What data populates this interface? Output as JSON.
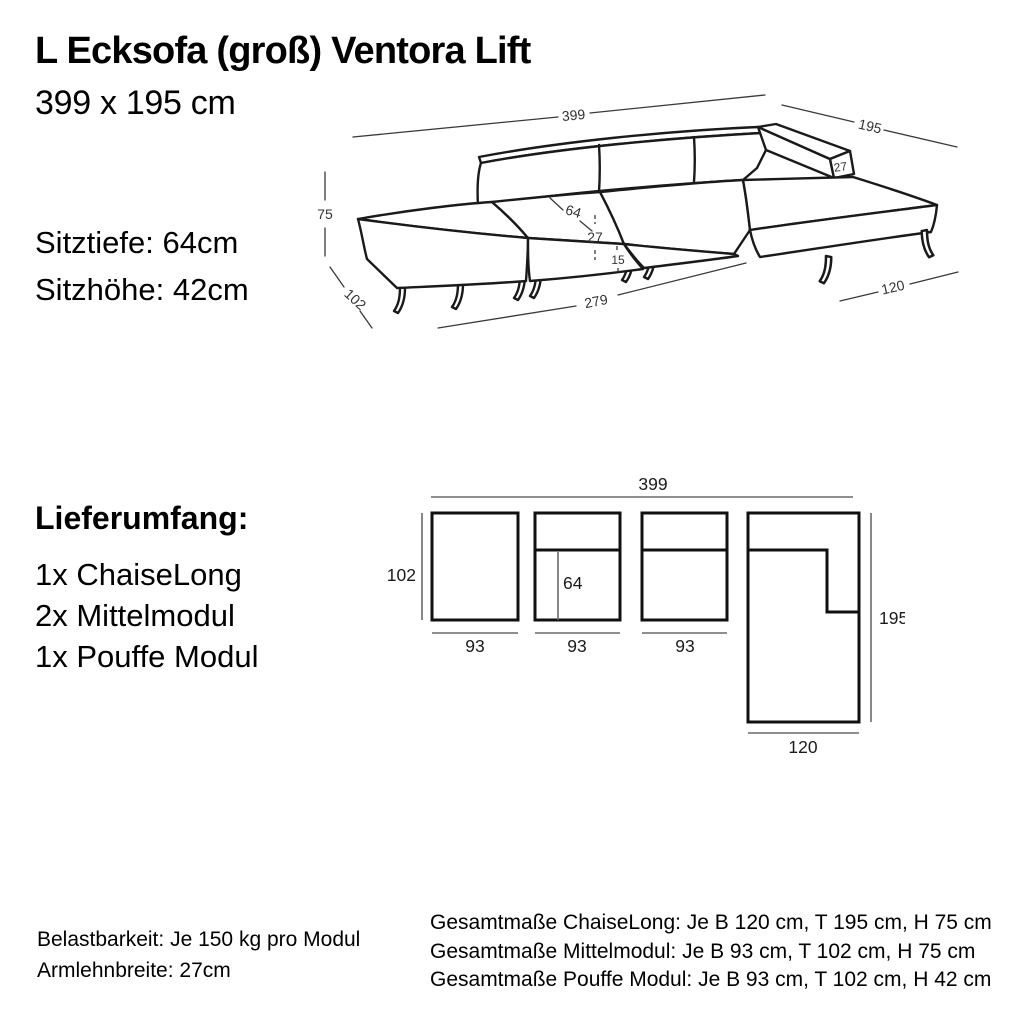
{
  "colors": {
    "background": "#ffffff",
    "line": "#1a1a1a",
    "text": "#000000",
    "dim_line": "#6a6a6a"
  },
  "header": {
    "title": "L Ecksofa (groß) Ventora Lift",
    "subtitle": "399 x 195 cm"
  },
  "specs": {
    "seat_depth": "Sitztiefe: 64cm",
    "seat_height": "Sitzhöhe: 42cm"
  },
  "iso_dims": {
    "total_width": "399",
    "total_depth": "195",
    "total_height": "75",
    "module_depth": "102",
    "seat_depth": "64",
    "seat_height": "27",
    "leg_height": "15",
    "modules_width": "279",
    "chaise_width": "120",
    "armrest_width": "27"
  },
  "delivery": {
    "heading": "Lieferumfang:",
    "items": [
      "1x ChaiseLong",
      "2x Mittelmodul",
      "1x Pouffe Modul"
    ]
  },
  "plan_dims": {
    "total_width": "399",
    "module_depth": "102",
    "seat_depth": "64",
    "module_width_1": "93",
    "module_width_2": "93",
    "module_width_3": "93",
    "chaise_depth": "195",
    "chaise_width": "120"
  },
  "footer": {
    "left_lines": [
      "Belastbarkeit: Je 150 kg pro Modul",
      "Armlehnbreite: 27cm"
    ],
    "right_lines": [
      "Gesamtmaße ChaiseLong: Je B 120 cm, T 195 cm, H 75 cm",
      "Gesamtmaße Mittelmodul: Je B 93 cm, T 102 cm, H 75 cm",
      "Gesamtmaße Pouffe Modul: Je B 93 cm, T 102 cm, H 42 cm"
    ]
  }
}
